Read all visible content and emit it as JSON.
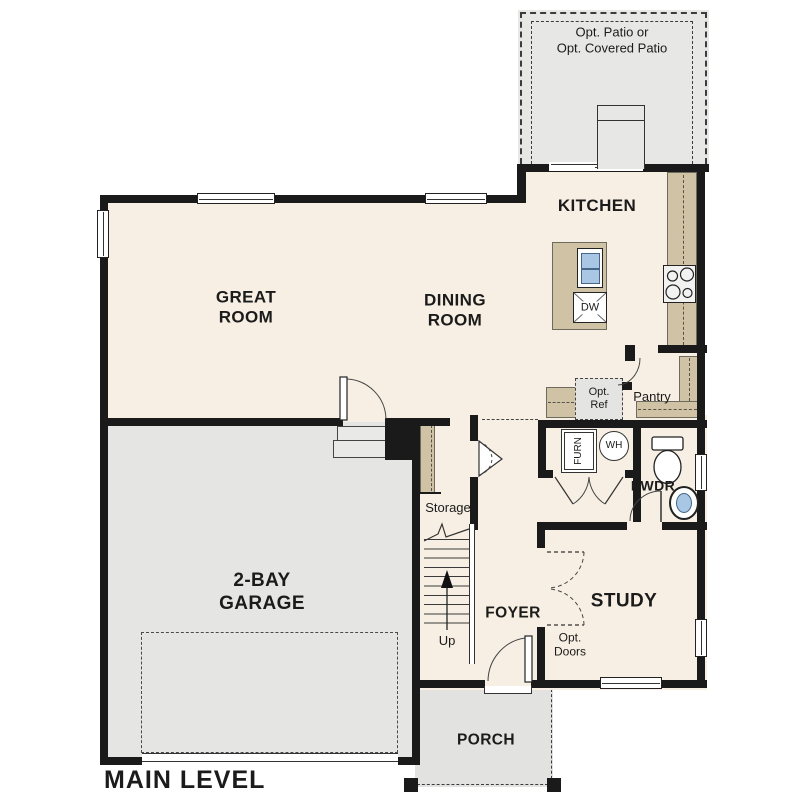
{
  "title": "MAIN LEVEL",
  "rooms": {
    "great_room_line1": "GREAT",
    "great_room_line2": "ROOM",
    "dining_room_line1": "DINING",
    "dining_room_line2": "ROOM",
    "kitchen": "KITCHEN",
    "garage_line1": "2-BAY",
    "garage_line2": "GARAGE",
    "foyer": "FOYER",
    "study": "STUDY",
    "porch": "PORCH",
    "powder": "PWDR",
    "pantry": "Pantry",
    "storage": "Storage",
    "stairs_up": "Up"
  },
  "options": {
    "patio_line1": "Opt. Patio or",
    "patio_line2": "Opt. Covered Patio",
    "ref_line1": "Opt.",
    "ref_line2": "Ref",
    "doors_line1": "Opt.",
    "doors_line2": "Doors"
  },
  "fixtures": {
    "dishwasher": "DW",
    "water_heater": "WH",
    "furnace": "FURN"
  },
  "colors": {
    "floor_cream": "#f7efe3",
    "floor_gray": "#e5e5e3",
    "patio_gray": "#e7e7e5",
    "counter_tan": "#cfc2a5",
    "wall_black": "#1a1a1a",
    "sink_blue": "#a9c7e4"
  }
}
